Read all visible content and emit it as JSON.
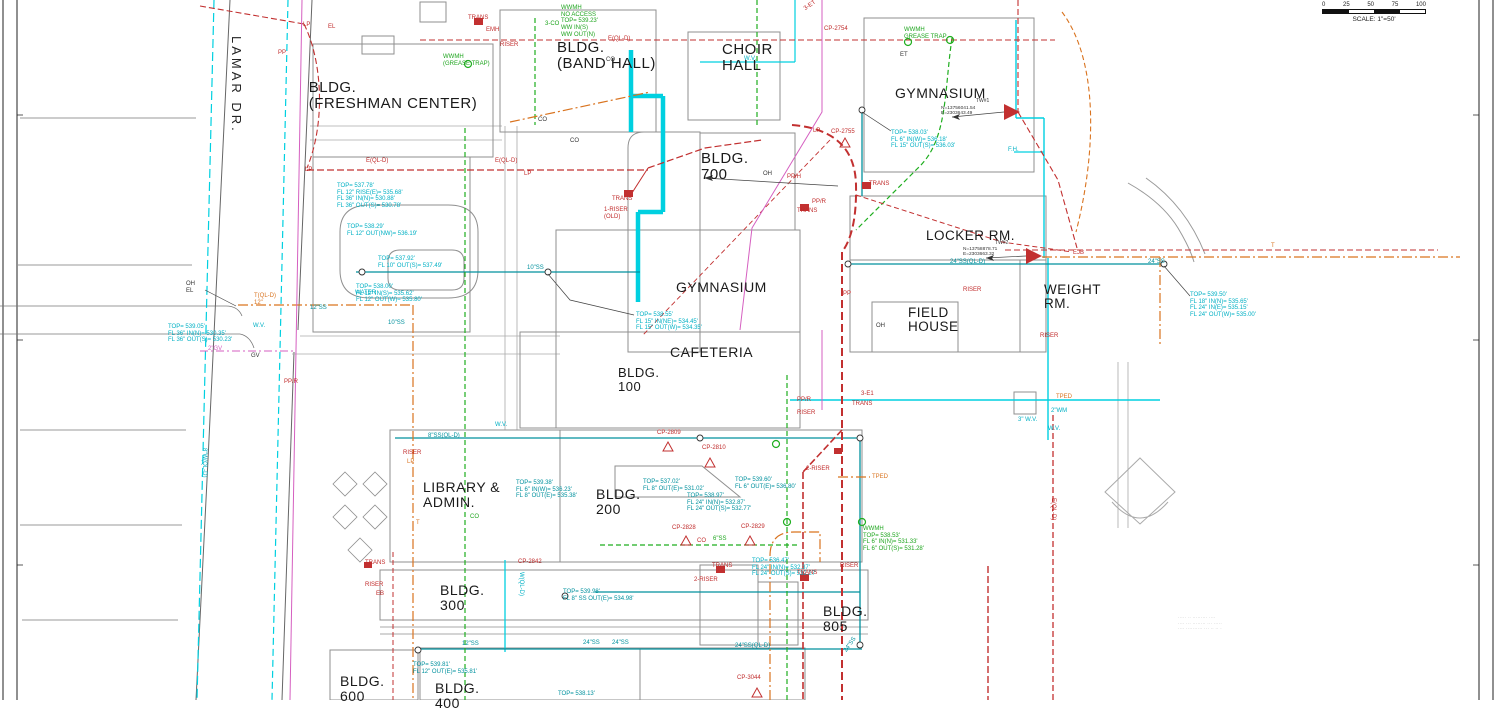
{
  "scale_bar": {
    "ticks": [
      "0",
      "25",
      "50",
      "75",
      "100"
    ],
    "label": "SCALE: 1\"=50'"
  },
  "street_label": "LAMAR DR.",
  "buildings": [
    {
      "n": "building-label-freshman-center",
      "t": [
        "BLDG.",
        "(FRESHMAN CENTER)"
      ],
      "x": 393,
      "y": 80,
      "s": 15,
      "a": "c"
    },
    {
      "n": "building-label-band-hall",
      "t": [
        "BLDG.",
        "(BAND HALL)"
      ],
      "x": 557,
      "y": 40,
      "s": 15
    },
    {
      "n": "building-label-choir-hall",
      "t": [
        "CHOIR",
        "HALL"
      ],
      "x": 722,
      "y": 42,
      "s": 15
    },
    {
      "n": "building-label-gymnasium-north",
      "t": [
        "GYMNASIUM"
      ],
      "x": 895,
      "y": 86,
      "s": 14
    },
    {
      "n": "building-label-bldg-700",
      "t": [
        "BLDG.",
        "700"
      ],
      "x": 701,
      "y": 151,
      "s": 15
    },
    {
      "n": "building-label-locker-rm",
      "t": [
        "LOCKER RM."
      ],
      "x": 926,
      "y": 229,
      "s": 13.5
    },
    {
      "n": "building-label-weight-rm",
      "t": [
        "WEIGHT",
        "RM."
      ],
      "x": 1044,
      "y": 283,
      "s": 13.5
    },
    {
      "n": "building-label-field-house",
      "t": [
        "FIELD",
        "HOUSE"
      ],
      "x": 908,
      "y": 306,
      "s": 13.5
    },
    {
      "n": "building-label-gymnasium-central",
      "t": [
        "GYMNASIUM"
      ],
      "x": 676,
      "y": 280,
      "s": 14
    },
    {
      "n": "building-label-cafeteria",
      "t": [
        "CAFETERIA"
      ],
      "x": 670,
      "y": 345,
      "s": 14
    },
    {
      "n": "building-label-bldg-100",
      "t": [
        "BLDG.",
        "100"
      ],
      "x": 618,
      "y": 366,
      "s": 13
    },
    {
      "n": "building-label-library-admin",
      "t": [
        "LIBRARY &",
        "ADMIN."
      ],
      "x": 423,
      "y": 480,
      "s": 14
    },
    {
      "n": "building-label-bldg-200",
      "t": [
        "BLDG.",
        "200"
      ],
      "x": 596,
      "y": 487,
      "s": 14
    },
    {
      "n": "building-label-bldg-300",
      "t": [
        "BLDG.",
        "300"
      ],
      "x": 440,
      "y": 583,
      "s": 14
    },
    {
      "n": "building-label-bldg-805",
      "t": [
        "BLDG.",
        "805"
      ],
      "x": 823,
      "y": 604,
      "s": 14
    },
    {
      "n": "building-label-bldg-600",
      "t": [
        "BLDG.",
        "600"
      ],
      "x": 340,
      "y": 674,
      "s": 14
    },
    {
      "n": "building-label-bldg-400",
      "t": [
        "BLDG.",
        "400"
      ],
      "x": 435,
      "y": 681,
      "s": 14
    }
  ],
  "callouts": [
    {
      "n": "manhole-data",
      "t": [
        "TOP= 537.78'",
        "FL 12\" RISE(E)= 535.68'",
        "FL 36\" IN(N)= 530.88'",
        "FL 36\" OUT(S)= 530.78'"
      ],
      "x": 337,
      "y": 183,
      "c": "c"
    },
    {
      "n": "manhole-data",
      "t": [
        "TOP= 538.29'",
        "FL 12\" OUT(NW)= 536.19'"
      ],
      "x": 347,
      "y": 224,
      "c": "c"
    },
    {
      "n": "manhole-data",
      "t": [
        "TOP= 537.92'",
        "FL 10\" OUT(S)= 537.49'"
      ],
      "x": 378,
      "y": 256,
      "c": "c"
    },
    {
      "n": "manhole-data",
      "t": [
        "TOP= 538.00'",
        "FL 12\" IN(S)= 535.62'",
        "FL 12\" OUT(W)= 535.80'"
      ],
      "x": 356,
      "y": 284,
      "c": "c"
    },
    {
      "n": "manhole-data",
      "t": [
        "TOP= 539.05'",
        "FL 36\" IN(N)= 530.35'",
        "FL 36\" OUT(S)= 530.23'"
      ],
      "x": 168,
      "y": 324,
      "c": "c"
    },
    {
      "n": "manhole-data",
      "t": [
        "TOP= 538.55'",
        "FL 15\" IN(NE)= 534.45'",
        "FL 15\" OUT(W)= 534.35'"
      ],
      "x": 636,
      "y": 312,
      "c": "c"
    },
    {
      "n": "manhole-data",
      "t": [
        "TOP= 538.03'",
        "FL 6\" IN(W)= 536.18'",
        "FL 15\" OUT(S)= 536.03'"
      ],
      "x": 891,
      "y": 130,
      "c": "c"
    },
    {
      "n": "manhole-data",
      "t": [
        "TOP= 539.50'",
        "FL 18\" IN(N)= 535.65'",
        "FL 24\" IN(E)= 535.15'",
        "FL 24\" OUT(W)= 535.00'"
      ],
      "x": 1190,
      "y": 292,
      "c": "c"
    },
    {
      "n": "manhole-data",
      "t": [
        "TOP= 539.60'",
        "FL 6\" OUT(E)= 536.80'"
      ],
      "x": 735,
      "y": 477,
      "c": "t"
    },
    {
      "n": "manhole-data",
      "t": [
        "TOP= 537.02'",
        "FL 8\" OUT(E)= 531.02'"
      ],
      "x": 643,
      "y": 479,
      "c": "t"
    },
    {
      "n": "manhole-data",
      "t": [
        "TOP= 539.38'",
        "FL 6\" IN(W)= 536.23'",
        "FL 8\" OUT(E)= 535.38'"
      ],
      "x": 516,
      "y": 480,
      "c": "t"
    },
    {
      "n": "manhole-data",
      "t": [
        "TOP= 538.97'",
        "FL 24\" IN(N)= 532.87'",
        "FL 24\" OUT(S)= 532.77'"
      ],
      "x": 687,
      "y": 493,
      "c": "t"
    },
    {
      "n": "manhole-data",
      "t": [
        "TOP= 536.47'",
        "FL 24\" IN(N)= 532.37'",
        "FL 24\" OUT(S)= 532.27'"
      ],
      "x": 752,
      "y": 558,
      "c": "c"
    },
    {
      "n": "manhole-data",
      "t": [
        "TOP= 539.98'",
        "FL 8\" SS OUT(E)= 534.98'"
      ],
      "x": 563,
      "y": 589,
      "c": "t"
    },
    {
      "n": "manhole-data",
      "t": [
        "TOP= 539.81'",
        "FL 12\" OUT(E)= 535.81'"
      ],
      "x": 413,
      "y": 662,
      "c": "t"
    },
    {
      "n": "manhole-data",
      "t": [
        "TOP= 538.13'"
      ],
      "x": 558,
      "y": 691,
      "c": "t"
    },
    {
      "n": "wwmh-label",
      "t": [
        "WWMH",
        "(GREASE TRAP)"
      ],
      "x": 443,
      "y": 54,
      "c": "g"
    },
    {
      "n": "wwmh-label",
      "t": [
        "WWMH",
        "GREASE TRAP"
      ],
      "x": 904,
      "y": 27,
      "c": "g"
    },
    {
      "n": "wwmh-label",
      "t": [
        "WWMH",
        "NO ACCESS",
        "TOP= 539.23'",
        "WW IN(S)",
        "WW OUT(N)"
      ],
      "x": 561,
      "y": 5,
      "c": "g"
    },
    {
      "n": "wwmh-label",
      "t": [
        "WWMH",
        "TOP= 538.53'",
        "FL 6\" IN(N)= 531.33'",
        "FL 6\" OUT(S)= 531.28'"
      ],
      "x": 863,
      "y": 526,
      "c": "g"
    },
    {
      "n": "pipe-label",
      "t": [
        "12\"SS"
      ],
      "x": 310,
      "y": 305,
      "c": "t"
    },
    {
      "n": "pipe-label",
      "t": [
        "10\"SS"
      ],
      "x": 388,
      "y": 320,
      "c": "t"
    },
    {
      "n": "pipe-label",
      "t": [
        "10\"SS"
      ],
      "x": 527,
      "y": 265,
      "c": "t"
    },
    {
      "n": "pipe-label",
      "t": [
        "24\"SS(QL-D)"
      ],
      "x": 950,
      "y": 259,
      "c": "t"
    },
    {
      "n": "pipe-label",
      "t": [
        "24\"SS"
      ],
      "x": 1148,
      "y": 259,
      "c": "t"
    },
    {
      "n": "pipe-label",
      "t": [
        "24\"SS"
      ],
      "x": 583,
      "y": 640,
      "c": "t"
    },
    {
      "n": "pipe-label",
      "t": [
        "24\"SS"
      ],
      "x": 612,
      "y": 640,
      "c": "t"
    },
    {
      "n": "pipe-label",
      "t": [
        "12\"SS"
      ],
      "x": 462,
      "y": 641,
      "c": "t"
    },
    {
      "n": "pipe-label",
      "t": [
        "24\"SS(QL-D)"
      ],
      "x": 735,
      "y": 643,
      "c": "t"
    },
    {
      "n": "pipe-label",
      "t": [
        "24\"SS"
      ],
      "x": 843,
      "y": 650,
      "c": "t",
      "r": -55
    },
    {
      "n": "pipe-label",
      "t": [
        "8\"SS(QL-D)"
      ],
      "x": 428,
      "y": 433,
      "c": "t"
    },
    {
      "n": "pipe-label",
      "t": [
        "6\"SS"
      ],
      "x": 713,
      "y": 536,
      "c": "g"
    },
    {
      "n": "pipe-label",
      "t": [
        "8\"W(QL-D)"
      ],
      "x": 207,
      "y": 448,
      "c": "c",
      "r": 90
    },
    {
      "n": "pipe-label",
      "t": [
        "W(QL-D)"
      ],
      "x": 524,
      "y": 572,
      "c": "c",
      "r": 90
    },
    {
      "n": "pipe-label",
      "t": [
        "WATER"
      ],
      "x": 355,
      "y": 290,
      "c": "c"
    },
    {
      "n": "valve-label",
      "t": [
        "W.V."
      ],
      "x": 253,
      "y": 323,
      "c": "c"
    },
    {
      "n": "valve-label",
      "t": [
        "W.V."
      ],
      "x": 495,
      "y": 422,
      "c": "c"
    },
    {
      "n": "valve-label",
      "t": [
        "W.V."
      ],
      "x": 744,
      "y": 56,
      "c": "c"
    },
    {
      "n": "valve-label",
      "t": [
        "2\"WM"
      ],
      "x": 1051,
      "y": 408,
      "c": "c"
    },
    {
      "n": "valve-label",
      "t": [
        "W.V."
      ],
      "x": 1048,
      "y": 426,
      "c": "c"
    },
    {
      "n": "valve-label",
      "t": [
        "3\" W.V."
      ],
      "x": 1018,
      "y": 417,
      "c": "c"
    },
    {
      "n": "hydrant-label",
      "t": [
        "F.H."
      ],
      "x": 1008,
      "y": 147,
      "c": "c"
    },
    {
      "n": "pipe-label",
      "t": [
        "T(QL-D)",
        "12\""
      ],
      "x": 254,
      "y": 293,
      "c": "o"
    },
    {
      "n": "pipe-label",
      "t": [
        "T"
      ],
      "x": 1271,
      "y": 243,
      "c": "o"
    },
    {
      "n": "pipe-label",
      "t": [
        "T"
      ],
      "x": 416,
      "y": 520,
      "c": "o"
    },
    {
      "n": "electric-label",
      "t": [
        "TRANS"
      ],
      "x": 468,
      "y": 15,
      "c": "r"
    },
    {
      "n": "electric-label",
      "t": [
        "EMH"
      ],
      "x": 486,
      "y": 27,
      "c": "r"
    },
    {
      "n": "electric-label",
      "t": [
        "RISER"
      ],
      "x": 500,
      "y": 42,
      "c": "r"
    },
    {
      "n": "electric-label",
      "t": [
        "TRANS"
      ],
      "x": 612,
      "y": 196,
      "c": "r"
    },
    {
      "n": "electric-label",
      "t": [
        "1-RISER",
        "(OLD)"
      ],
      "x": 604,
      "y": 207,
      "c": "r"
    },
    {
      "n": "electric-label",
      "t": [
        "TRANS"
      ],
      "x": 869,
      "y": 181,
      "c": "r"
    },
    {
      "n": "electric-label",
      "t": [
        "TRANS"
      ],
      "x": 797,
      "y": 208,
      "c": "r"
    },
    {
      "n": "electric-label",
      "t": [
        "RISER"
      ],
      "x": 963,
      "y": 287,
      "c": "r"
    },
    {
      "n": "electric-label",
      "t": [
        "EJB"
      ],
      "x": 1073,
      "y": 250,
      "c": "r"
    },
    {
      "n": "electric-label",
      "t": [
        "RISER"
      ],
      "x": 403,
      "y": 450,
      "c": "r"
    },
    {
      "n": "electric-label",
      "t": [
        "LP"
      ],
      "x": 407,
      "y": 459,
      "c": "o"
    },
    {
      "n": "electric-label",
      "t": [
        "TRANS"
      ],
      "x": 712,
      "y": 563,
      "c": "r"
    },
    {
      "n": "electric-label",
      "t": [
        "2-RISER"
      ],
      "x": 694,
      "y": 577,
      "c": "r"
    },
    {
      "n": "electric-label",
      "t": [
        "TRANS"
      ],
      "x": 797,
      "y": 570,
      "c": "r"
    },
    {
      "n": "electric-label",
      "t": [
        "RISER"
      ],
      "x": 840,
      "y": 563,
      "c": "r"
    },
    {
      "n": "electric-label",
      "t": [
        "RISER"
      ],
      "x": 797,
      "y": 410,
      "c": "r"
    },
    {
      "n": "electric-label",
      "t": [
        "3-E1"
      ],
      "x": 861,
      "y": 391,
      "c": "r"
    },
    {
      "n": "electric-label",
      "t": [
        "PP/R"
      ],
      "x": 797,
      "y": 397,
      "c": "r"
    },
    {
      "n": "electric-label",
      "t": [
        "TRANS"
      ],
      "x": 852,
      "y": 401,
      "c": "r"
    },
    {
      "n": "electric-label",
      "t": [
        "2-RISER"
      ],
      "x": 806,
      "y": 466,
      "c": "r"
    },
    {
      "n": "electric-label",
      "t": [
        "RISER"
      ],
      "x": 1040,
      "y": 333,
      "c": "r"
    },
    {
      "n": "electric-label",
      "t": [
        "TRANS"
      ],
      "x": 365,
      "y": 560,
      "c": "r"
    },
    {
      "n": "electric-label",
      "t": [
        "RISER"
      ],
      "x": 365,
      "y": 582,
      "c": "r"
    },
    {
      "n": "electric-label",
      "t": [
        "EB"
      ],
      "x": 376,
      "y": 591,
      "c": "r"
    },
    {
      "n": "control-point-label",
      "t": [
        "CP-2754"
      ],
      "x": 824,
      "y": 26,
      "c": "r"
    },
    {
      "n": "control-point-label",
      "t": [
        "CP-2755"
      ],
      "x": 831,
      "y": 129,
      "c": "r"
    },
    {
      "n": "control-point-label",
      "t": [
        "CP-2809"
      ],
      "x": 657,
      "y": 430,
      "c": "r"
    },
    {
      "n": "control-point-label",
      "t": [
        "CP-2810"
      ],
      "x": 702,
      "y": 445,
      "c": "r"
    },
    {
      "n": "control-point-label",
      "t": [
        "CP-2828"
      ],
      "x": 672,
      "y": 525,
      "c": "r"
    },
    {
      "n": "control-point-label",
      "t": [
        "CP-2829"
      ],
      "x": 741,
      "y": 524,
      "c": "r"
    },
    {
      "n": "control-point-label",
      "t": [
        "CP-2842"
      ],
      "x": 518,
      "y": 559,
      "c": "r"
    },
    {
      "n": "control-point-label",
      "t": [
        "CP-3044"
      ],
      "x": 737,
      "y": 675,
      "c": "r"
    },
    {
      "n": "pole-label",
      "t": [
        "LP"
      ],
      "x": 303,
      "y": 22,
      "c": "r"
    },
    {
      "n": "pole-label",
      "t": [
        "LP"
      ],
      "x": 305,
      "y": 167,
      "c": "r"
    },
    {
      "n": "pole-label",
      "t": [
        "LP"
      ],
      "x": 524,
      "y": 171,
      "c": "r"
    },
    {
      "n": "pole-label",
      "t": [
        "LP"
      ],
      "x": 813,
      "y": 128,
      "c": "r"
    },
    {
      "n": "pole-label",
      "t": [
        "PP"
      ],
      "x": 278,
      "y": 50,
      "c": "r"
    },
    {
      "n": "pole-label",
      "t": [
        "PP"
      ],
      "x": 843,
      "y": 291,
      "c": "r"
    },
    {
      "n": "pole-label",
      "t": [
        "PP/R"
      ],
      "x": 284,
      "y": 379,
      "c": "r"
    },
    {
      "n": "pole-label",
      "t": [
        "PP/H"
      ],
      "x": 787,
      "y": 174,
      "c": "r"
    },
    {
      "n": "pole-label",
      "t": [
        "PP/R"
      ],
      "x": 812,
      "y": 199,
      "c": "r"
    },
    {
      "n": "overhead-label",
      "t": [
        "OH",
        "EL"
      ],
      "x": 186,
      "y": 281,
      "c": "k"
    },
    {
      "n": "overhead-label",
      "t": [
        "OH"
      ],
      "x": 876,
      "y": 323,
      "c": "k"
    },
    {
      "n": "overhead-label",
      "t": [
        "OH"
      ],
      "x": 763,
      "y": 171,
      "c": "k"
    },
    {
      "n": "electric-line-label",
      "t": [
        "E(QL-D)"
      ],
      "x": 366,
      "y": 158,
      "c": "r"
    },
    {
      "n": "electric-line-label",
      "t": [
        "E(QL-D)"
      ],
      "x": 495,
      "y": 158,
      "c": "r"
    },
    {
      "n": "electric-line-label",
      "t": [
        "E(QL-D)"
      ],
      "x": 608,
      "y": 36,
      "c": "r"
    },
    {
      "n": "electric-line-label",
      "t": [
        "E(QL-D)"
      ],
      "x": 1056,
      "y": 498,
      "c": "r",
      "r": 90
    },
    {
      "n": "electric-line-label",
      "t": [
        "EL"
      ],
      "x": 328,
      "y": 24,
      "c": "r"
    },
    {
      "n": "electric-line-label",
      "t": [
        "3-ET"
      ],
      "x": 803,
      "y": 7,
      "c": "r",
      "r": -35
    },
    {
      "n": "electric-line-label",
      "t": [
        "ET"
      ],
      "x": 900,
      "y": 52,
      "c": "k"
    },
    {
      "n": "telecom-label",
      "t": [
        "TPED"
      ],
      "x": 872,
      "y": 474,
      "c": "o"
    },
    {
      "n": "telecom-label",
      "t": [
        "TPED"
      ],
      "x": 1056,
      "y": 394,
      "c": "o"
    },
    {
      "n": "valve-label",
      "t": [
        "GV"
      ],
      "x": 251,
      "y": 353,
      "c": "k"
    },
    {
      "n": "valve-label",
      "t": [
        "2\"GV"
      ],
      "x": 208,
      "y": 346,
      "c": "p"
    },
    {
      "n": "cleanout-label",
      "t": [
        "CO"
      ],
      "x": 470,
      "y": 514,
      "c": "g"
    },
    {
      "n": "cleanout-label",
      "t": [
        "3-CO"
      ],
      "x": 545,
      "y": 21,
      "c": "g"
    },
    {
      "n": "cleanout-label",
      "t": [
        "CO"
      ],
      "x": 697,
      "y": 538,
      "c": "r"
    },
    {
      "n": "cleanout-label",
      "t": [
        "CO"
      ],
      "x": 538,
      "y": 117,
      "c": "k"
    },
    {
      "n": "cleanout-label",
      "t": [
        "CO"
      ],
      "x": 606,
      "y": 57,
      "c": "k"
    },
    {
      "n": "cleanout-label",
      "t": [
        "CO"
      ],
      "x": 570,
      "y": 138,
      "c": "k"
    },
    {
      "n": "survey-point-label",
      "t": [
        "TW#1"
      ],
      "x": 976,
      "y": 99,
      "c": "k",
      "s": 5
    },
    {
      "n": "survey-point-data",
      "t": [
        "N=13756041.54",
        "E=2303643.49"
      ],
      "x": 941,
      "y": 106,
      "c": "k",
      "s": 4.8
    },
    {
      "n": "survey-point-label",
      "t": [
        "TW#2"
      ],
      "x": 995,
      "y": 241,
      "c": "k",
      "s": 5
    },
    {
      "n": "survey-point-data",
      "t": [
        "N=13758878.71",
        "E=2303663.32"
      ],
      "x": 963,
      "y": 247,
      "c": "k",
      "s": 4.8
    }
  ],
  "fine_print": [
    "·····  ··  ·········  ····",
    "····  ···  ········  ···  ·····",
    "····  ··········  ···  ··  ·· ·"
  ]
}
